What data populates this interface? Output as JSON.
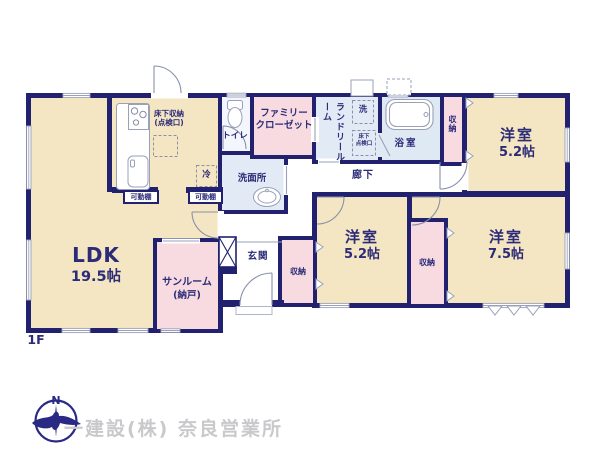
{
  "floor": {
    "label": "1F"
  },
  "footer": {
    "company": "一建設(株) 奈良営業所",
    "compass_n": "N"
  },
  "colors": {
    "wall": "#212170",
    "room_beige": "#f4e6c2",
    "room_pink": "#f8dbe1",
    "room_blue": "#e2ebf5",
    "room_toilet": "#f3f6fc",
    "line_gray": "#9aa0b8",
    "text_navy": "#2b2b78",
    "logo_navy": "#2a2a85",
    "company_gray": "#c9c9cc"
  },
  "rooms": {
    "ldk": {
      "name": "LDK",
      "size": "19.5帖"
    },
    "sunroom": {
      "name": "サンルーム",
      "sub": "(納戸)"
    },
    "bedroom_top": {
      "name": "洋室",
      "size": "5.2帖"
    },
    "bedroom_mid": {
      "name": "洋室",
      "size": "5.2帖"
    },
    "bedroom_right": {
      "name": "洋室",
      "size": "7.5帖"
    },
    "toilet": {
      "name": "トイレ"
    },
    "washroom": {
      "name": "洗面所"
    },
    "family_closet": {
      "line1": "ファミリー",
      "line2": "クローゼット"
    },
    "laundry": {
      "line1": "ランドリー",
      "line2": "ルーム"
    },
    "bath": {
      "name": "浴室"
    },
    "hallway": {
      "name": "廊下"
    },
    "entrance": {
      "name": "玄関"
    },
    "closet": {
      "name": "収納"
    },
    "shelf": {
      "name": "可動棚"
    },
    "underfloor_storage": {
      "line1": "床下収納",
      "line2": "(点検口)"
    },
    "underfloor_hatch": {
      "line1": "床下",
      "line2": "点検口"
    },
    "fridge": {
      "name": "冷"
    },
    "washer": {
      "name": "洗"
    }
  }
}
